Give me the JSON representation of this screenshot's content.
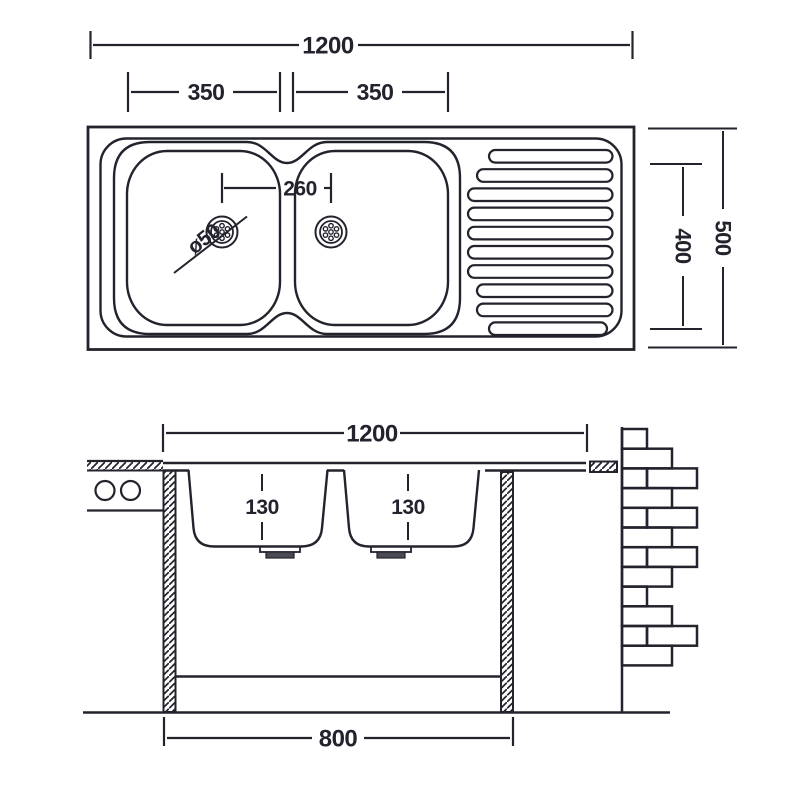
{
  "drawing": {
    "subject": "double-bowl sink with drainboard, dimensioned technical drawing",
    "line_color": "#23232d",
    "background": "#ffffff",
    "drain_flange_color": "#4a4a54",
    "top_view": {
      "overall_width_label": "1200",
      "left_bowl_width_label": "350",
      "right_bowl_width_label": "350",
      "drain_spacing_label": "260",
      "drain_diameter_label": "ø50",
      "overall_depth_label": "500",
      "inner_depth_label": "400"
    },
    "section_view": {
      "overall_width_label": "1200",
      "left_bowl_depth_label": "130",
      "right_bowl_depth_label": "130",
      "base_width_label": "800"
    }
  }
}
